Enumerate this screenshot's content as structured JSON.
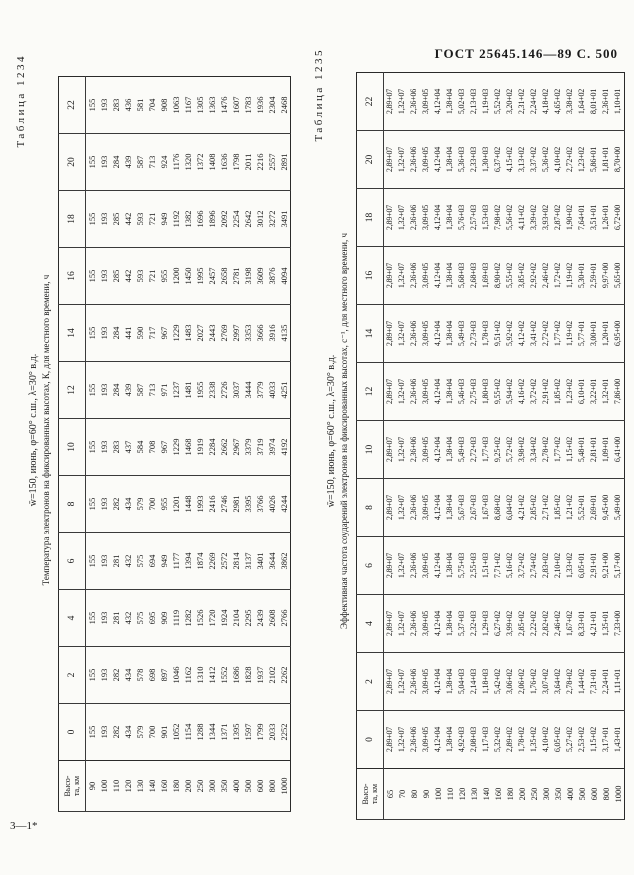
{
  "page": {
    "gost_header": "ГОСТ 25645.146—89 С. 500",
    "signature_mark": "3—1*"
  },
  "tables": [
    {
      "label": "Таблица 1234",
      "conditions": "w̄=150, июнь, φ=60° с.ш., λ=30° в.д.",
      "title": "Температура электронов на фиксированных высотах, К, для местного времени, ч",
      "row_header_line1": "Высо-",
      "row_header_line2": "та, км",
      "time_hours": [
        "0",
        "2",
        "4",
        "6",
        "8",
        "10",
        "12",
        "14",
        "16",
        "18",
        "20",
        "22"
      ],
      "altitudes_km": [
        "90",
        "100",
        "110",
        "120",
        "130",
        "140",
        "160",
        "180",
        "200",
        "250",
        "300",
        "350",
        "400",
        "500",
        "600",
        "800",
        "1000"
      ],
      "values_by_time": [
        [
          "155",
          "193",
          "282",
          "434",
          "579",
          "700",
          "901",
          "1052",
          "1154",
          "1288",
          "1344",
          "1371",
          "1395",
          "1597",
          "1799",
          "2033",
          "2252"
        ],
        [
          "155",
          "193",
          "282",
          "434",
          "578",
          "698",
          "897",
          "1046",
          "1162",
          "1310",
          "1412",
          "1552",
          "1686",
          "1828",
          "1937",
          "2102",
          "2262"
        ],
        [
          "155",
          "193",
          "281",
          "432",
          "575",
          "695",
          "909",
          "1119",
          "1282",
          "1526",
          "1720",
          "1924",
          "2104",
          "2295",
          "2439",
          "2608",
          "2766"
        ],
        [
          "155",
          "193",
          "281",
          "432",
          "575",
          "694",
          "949",
          "1177",
          "1394",
          "1874",
          "2269",
          "2572",
          "2814",
          "3137",
          "3401",
          "3644",
          "3862"
        ],
        [
          "155",
          "193",
          "282",
          "434",
          "579",
          "700",
          "955",
          "1201",
          "1448",
          "1993",
          "2416",
          "2746",
          "2981",
          "3395",
          "3766",
          "4026",
          "4244"
        ],
        [
          "155",
          "193",
          "283",
          "437",
          "584",
          "708",
          "967",
          "1229",
          "1468",
          "1919",
          "2284",
          "2662",
          "2967",
          "3379",
          "3719",
          "3974",
          "4192"
        ],
        [
          "155",
          "193",
          "284",
          "439",
          "587",
          "713",
          "971",
          "1237",
          "1481",
          "1955",
          "2338",
          "2726",
          "3037",
          "3444",
          "3779",
          "4033",
          "4251"
        ],
        [
          "155",
          "193",
          "284",
          "441",
          "590",
          "717",
          "967",
          "1229",
          "1483",
          "2027",
          "2443",
          "2769",
          "2997",
          "3353",
          "3666",
          "3916",
          "4135"
        ],
        [
          "155",
          "193",
          "285",
          "442",
          "593",
          "721",
          "955",
          "1200",
          "1450",
          "1995",
          "2457",
          "2658",
          "2781",
          "3198",
          "3609",
          "3876",
          "4094"
        ],
        [
          "155",
          "193",
          "285",
          "442",
          "593",
          "721",
          "949",
          "1192",
          "1382",
          "1696",
          "1896",
          "2092",
          "2254",
          "2642",
          "3012",
          "3272",
          "3491"
        ],
        [
          "155",
          "193",
          "284",
          "439",
          "587",
          "713",
          "924",
          "1176",
          "1320",
          "1372",
          "1408",
          "1636",
          "1798",
          "2011",
          "2216",
          "2557",
          "2891"
        ],
        [
          "155",
          "193",
          "283",
          "436",
          "581",
          "704",
          "908",
          "1063",
          "1167",
          "1305",
          "1363",
          "1476",
          "1607",
          "1783",
          "1936",
          "2304",
          "2468"
        ]
      ]
    },
    {
      "label": "Таблица 1235",
      "conditions": "w̄=150, июнь, φ=60° с.ш., λ=30° в.д.",
      "title": "Эффективная частота соударений электронов на фиксированных высотах, с⁻¹, для местного времени, ч",
      "row_header_line1": "Высо-",
      "row_header_line2": "та, км",
      "time_hours": [
        "0",
        "2",
        "4",
        "6",
        "8",
        "10",
        "12",
        "14",
        "16",
        "18",
        "20",
        "22"
      ],
      "altitudes_km": [
        "65",
        "70",
        "80",
        "90",
        "100",
        "110",
        "120",
        "130",
        "140",
        "160",
        "180",
        "200",
        "250",
        "300",
        "350",
        "400",
        "500",
        "600",
        "800",
        "1000"
      ],
      "values_by_time": [
        [
          "2,89+07",
          "1,32+07",
          "2,36+06",
          "3,09+05",
          "4,12+04",
          "1,38+04",
          "4,92+03",
          "2,08+03",
          "1,17+03",
          "5,32+02",
          "2,89+02",
          "1,78+02",
          "1,35+02",
          "4,10+02",
          "6,05+02",
          "5,27+02",
          "2,53+02",
          "1,15+02",
          "3,17+01",
          "1,43+01"
        ],
        [
          "2,89+07",
          "1,32+07",
          "2,36+06",
          "3,09+05",
          "4,12+04",
          "1,38+04",
          "5,04+03",
          "2,14+03",
          "1,18+03",
          "5,42+02",
          "3,06+02",
          "2,06+02",
          "1,76+02",
          "3,07+02",
          "3,64+02",
          "2,78+02",
          "1,44+02",
          "7,31+01",
          "2,24+01",
          "1,11+01"
        ],
        [
          "2,89+07",
          "1,32+07",
          "2,36+06",
          "3,09+05",
          "4,12+04",
          "1,38+04",
          "5,37+03",
          "2,32+03",
          "1,29+03",
          "6,27+02",
          "3,99+02",
          "2,85+02",
          "2,22+02",
          "2,82+02",
          "2,46+02",
          "1,67+02",
          "8,33+01",
          "4,21+01",
          "1,35+01",
          "7,33+00"
        ],
        [
          "2,89+07",
          "1,32+07",
          "2,36+06",
          "3,09+05",
          "4,12+04",
          "1,38+04",
          "5,75+03",
          "2,55+03",
          "1,51+03",
          "7,71+02",
          "5,16+02",
          "3,72+02",
          "2,74+02",
          "2,83+02",
          "2,10+02",
          "1,33+02",
          "6,05+01",
          "2,91+01",
          "9,21+00",
          "5,17+00"
        ],
        [
          "2,89+07",
          "1,32+07",
          "2,36+06",
          "3,09+05",
          "4,12+04",
          "1,38+04",
          "5,67+03",
          "2,67+03",
          "1,67+03",
          "8,68+02",
          "6,04+02",
          "4,21+02",
          "2,85+02",
          "2,71+02",
          "1,85+02",
          "1,21+02",
          "5,52+01",
          "2,69+01",
          "9,45+00",
          "5,49+00"
        ],
        [
          "2,89+07",
          "1,32+07",
          "2,36+06",
          "3,09+05",
          "4,12+04",
          "1,38+04",
          "5,49+03",
          "2,72+03",
          "1,77+03",
          "9,25+02",
          "5,72+02",
          "3,98+02",
          "3,34+02",
          "2,78+02",
          "1,77+02",
          "1,15+02",
          "5,48+01",
          "2,81+01",
          "1,09+01",
          "6,41+00"
        ],
        [
          "2,89+07",
          "1,32+07",
          "2,36+06",
          "3,09+05",
          "4,12+04",
          "1,38+04",
          "5,46+03",
          "2,75+03",
          "1,80+03",
          "9,55+02",
          "5,94+02",
          "4,16+02",
          "3,72+02",
          "2,91+02",
          "1,85+02",
          "1,23+02",
          "6,10+01",
          "3,22+01",
          "1,32+01",
          "7,86+00"
        ],
        [
          "2,89+07",
          "1,32+07",
          "2,36+06",
          "3,09+05",
          "4,12+04",
          "1,38+04",
          "5,49+03",
          "2,73+03",
          "1,78+03",
          "9,51+02",
          "5,92+02",
          "4,12+02",
          "3,41+02",
          "2,72+02",
          "1,77+02",
          "1,19+02",
          "5,77+01",
          "3,00+01",
          "1,20+01",
          "6,95+00"
        ],
        [
          "2,89+07",
          "1,32+07",
          "2,36+06",
          "3,09+05",
          "4,12+04",
          "1,38+04",
          "5,68+03",
          "2,68+03",
          "1,69+03",
          "8,90+02",
          "5,55+02",
          "3,85+02",
          "2,92+02",
          "2,46+02",
          "1,72+02",
          "1,19+02",
          "5,30+01",
          "2,59+01",
          "9,97+00",
          "5,65+00"
        ],
        [
          "2,89+07",
          "1,32+07",
          "2,36+06",
          "3,09+05",
          "4,12+04",
          "1,38+04",
          "5,76+03",
          "2,57+03",
          "1,53+03",
          "7,98+02",
          "5,56+02",
          "4,11+02",
          "3,39+02",
          "3,93+02",
          "2,87+02",
          "1,90+02",
          "7,64+01",
          "3,51+01",
          "1,26+01",
          "6,72+00"
        ],
        [
          "2,89+07",
          "1,32+07",
          "2,36+06",
          "3,09+05",
          "4,12+04",
          "1,38+04",
          "5,36+03",
          "2,33+03",
          "1,30+03",
          "6,37+02",
          "4,15+02",
          "3,13+02",
          "3,37+02",
          "5,36+02",
          "4,10+02",
          "2,72+02",
          "1,23+02",
          "5,86+01",
          "1,81+01",
          "8,70+00"
        ],
        [
          "2,89+07",
          "1,32+07",
          "2,36+06",
          "3,09+05",
          "4,12+04",
          "1,38+04",
          "5,02+03",
          "2,13+03",
          "1,19+03",
          "5,52+02",
          "3,20+02",
          "2,31+02",
          "2,24+02",
          "4,18+02",
          "4,65+02",
          "3,38+02",
          "1,64+02",
          "8,01+01",
          "2,36+01",
          "1,10+01"
        ]
      ]
    }
  ]
}
